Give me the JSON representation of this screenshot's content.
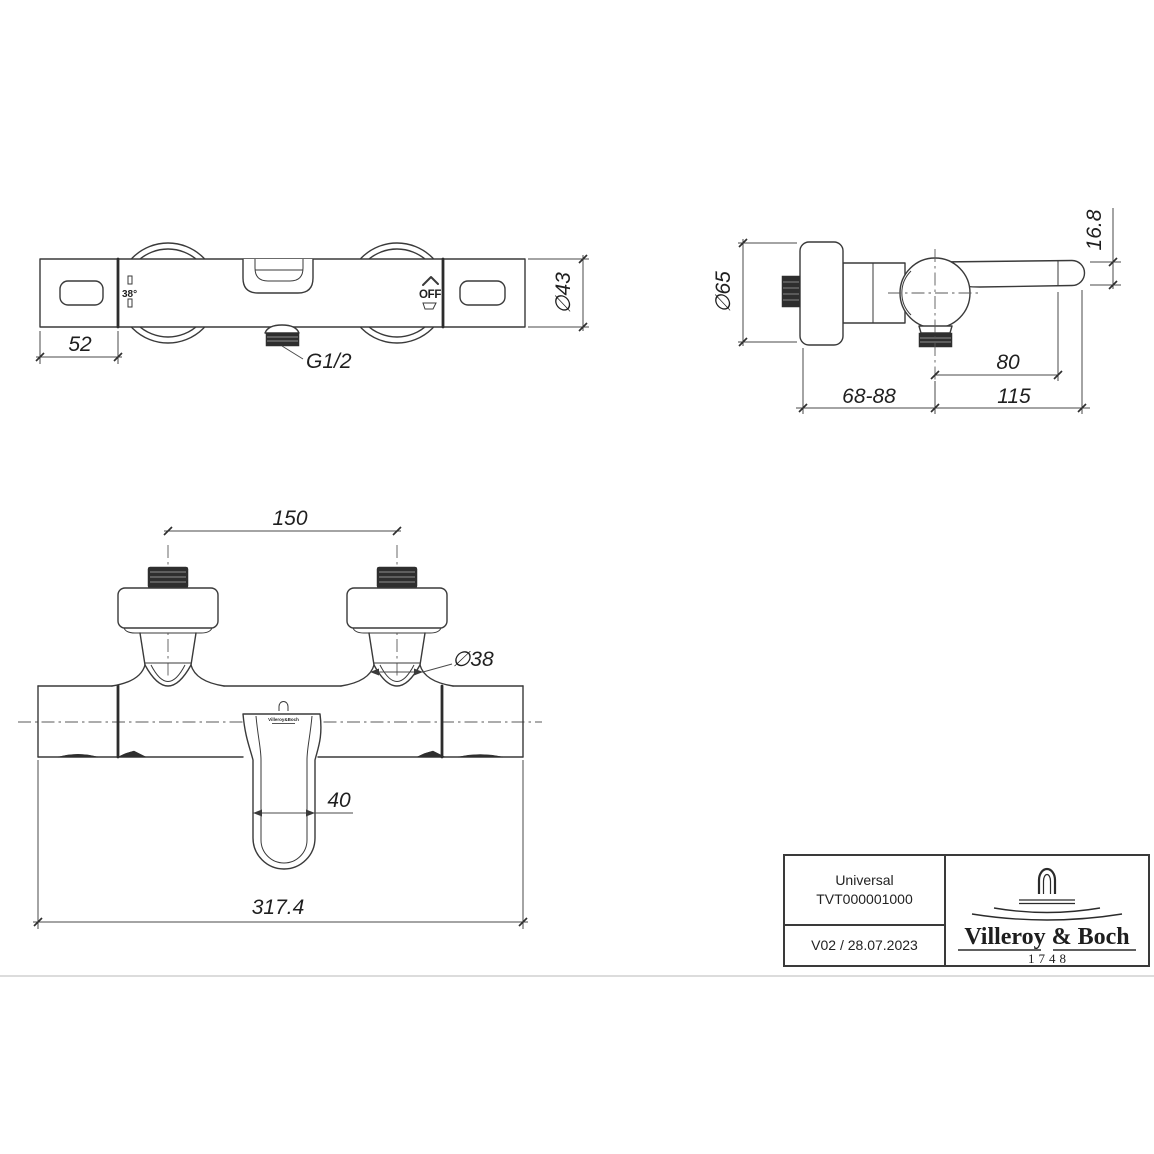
{
  "drawing": {
    "front_view": {
      "temp_stop_label": "38°",
      "off_label": "OFF",
      "cap_width_dim": "52",
      "thread_label": "G1/2",
      "body_diameter_dim": "∅43"
    },
    "side_view": {
      "plate_diameter_dim": "∅65",
      "lever_end_height_dim": "16.8",
      "handle_offset_dim": "80",
      "wall_distance_dim": "68-88",
      "handle_length_dim": "115"
    },
    "bottom_view": {
      "connection_spacing_dim": "150",
      "connector_diameter_dim": "∅38",
      "spout_width_dim": "40",
      "overall_width_dim": "317.4",
      "mini_logo_text": "Villeroy&Boch"
    }
  },
  "title_block": {
    "product_name": "Universal",
    "article_number": "TVT000001000",
    "revision": "V02 / 28.07.2023",
    "brand_name": "Villeroy & Boch",
    "brand_year": "1748"
  }
}
